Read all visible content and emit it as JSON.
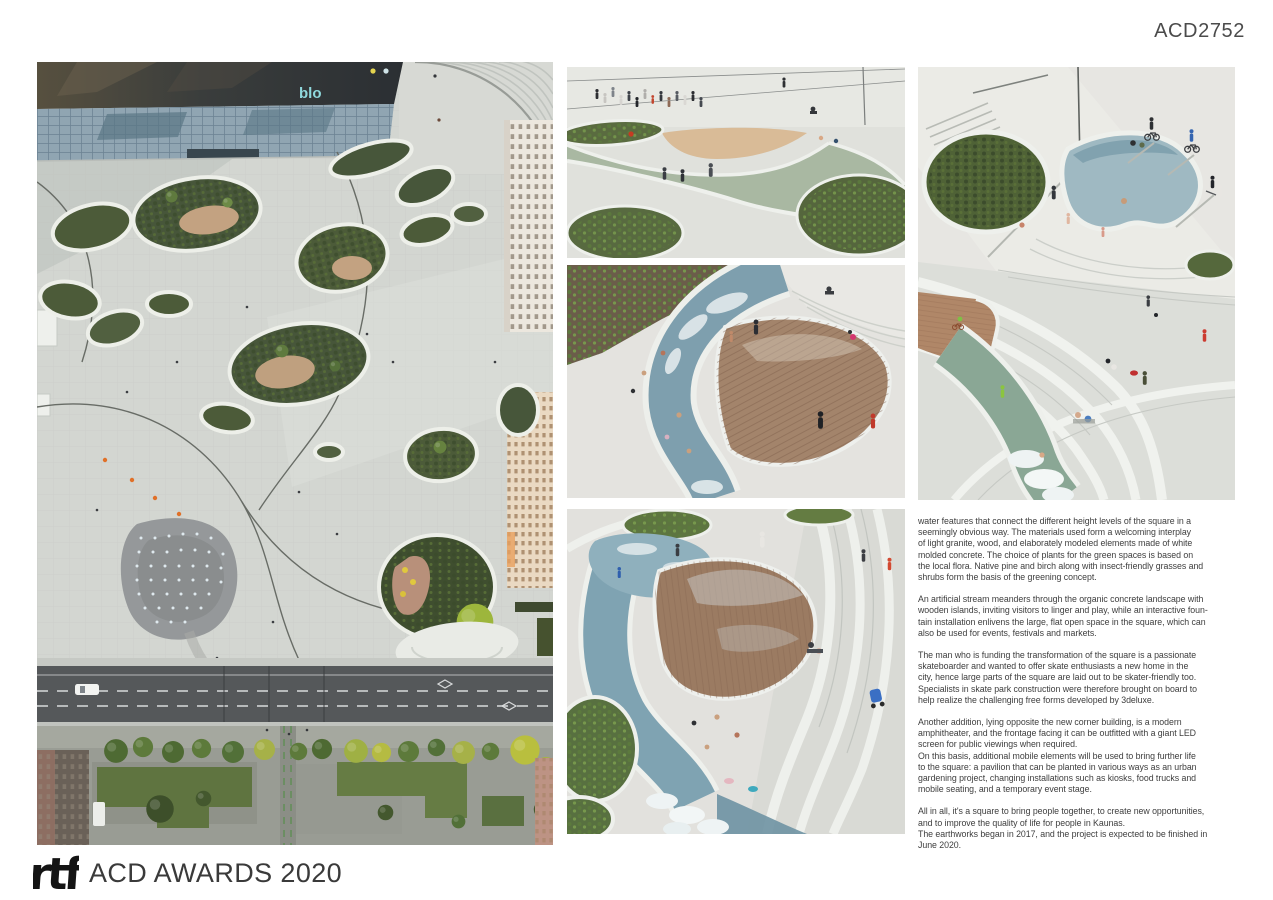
{
  "header": {
    "submission_id": "ACD2752"
  },
  "footer": {
    "logo_text": "rtf",
    "title": "ACD AWARDS 2020"
  },
  "photos": {
    "aerial": {
      "roof_sign": "blo"
    }
  },
  "article": {
    "paragraphs": [
      "water features that connect the different height levels of the square in a\nseemingly obvious way. The materials used form a welcoming interplay\nof light granite, wood, and elaborately modeled elements made of white\nmolded concrete. The choice of plants for the green spaces is based on\nthe local flora. Native pine and birch along with insect-friendly grasses and\nshrubs form the basis of the greening concept.",
      "An artificial stream meanders through the organic concrete landscape with\nwooden islands, inviting visitors to linger and play, while an interactive foun-\ntain installation enlivens the large, flat open space in the square, which can\nalso be used for events, festivals and markets.",
      "The man who is funding the transformation of the square is a passionate\nskateboarder and wanted to offer skate enthusiasts a new home in the\ncity, hence large parts of the square are laid out to be skater-friendly too.\nSpecialists in skate park construction were therefore brought on board to\nhelp realize the challenging free forms developed by 3deluxe.",
      "Another addition, lying opposite the new corner building, is a modern\namphitheater, and the frontage facing it can be outfitted with a giant LED\nscreen for public viewings when required.\nOn this basis, additional mobile elements will be used to bring further life\nto the square: a pavilion that can be planted in various ways as an urban\ngardening project, changing installations such as kiosks, food trucks and\nmobile seating, and a temporary event stage.",
      "All in all, it's a square to bring people together, to create new opportunities,\nand to improve the quality of life for people in Kaunas.\nThe earthworks began in 2017, and the project is expected to be finished in\nJune 2020."
    ]
  },
  "colors": {
    "text": "#3e3e3e",
    "id_text": "#4b4b4b",
    "logo": "#141414",
    "roof_sign": "#8fd8dc"
  }
}
